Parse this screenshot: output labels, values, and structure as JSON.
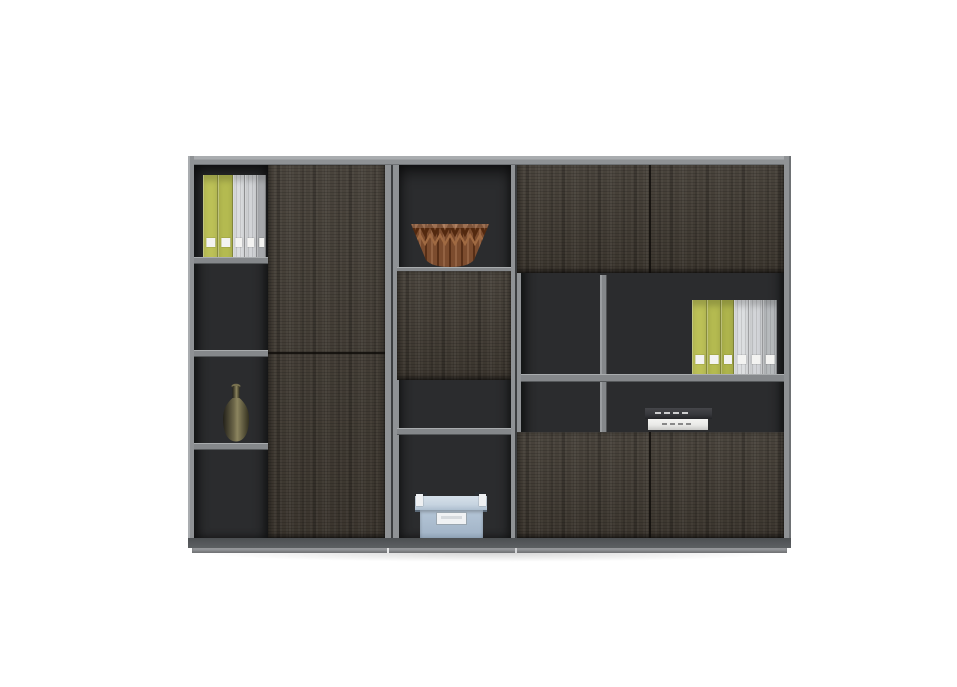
{
  "image": {
    "type": "product-photo",
    "subject": "dark wood modular office wall cabinet with open shelves, doors and decor objects",
    "background": "#ffffff"
  },
  "palette": {
    "background": "#ffffff",
    "frame": "#8f9295",
    "frame_light": "#a9acaf",
    "frame_dark": "#6e7174",
    "seam": "#3c3e40",
    "interior": "#2b2c2e",
    "interior_deep": "#1f2022",
    "wood": "#403a32",
    "wood_light": "#5a5248",
    "wood_dark": "#2a2620",
    "shelf": "#85888b",
    "rail": "#5d6063",
    "plinth_lip": "#96989b",
    "binder_label": "#f3f3f1",
    "book_dark": "#36373b",
    "book_white": "#e9e9e7",
    "box_blue": "#b5c6d7",
    "box_lid": "#c7d4e0",
    "box_label": "#f0f2f4"
  },
  "cabinet": {
    "label": "three-module wall cabinet",
    "modules": [
      {
        "id": "left",
        "features": [
          "open-shelf-column with four compartments",
          "tall two-panel wood door"
        ]
      },
      {
        "id": "middle",
        "features": [
          "open display compartment",
          "wood panel",
          "open shelf",
          "lower storage compartment"
        ]
      },
      {
        "id": "right",
        "features": [
          "two top doors",
          "open shelves with center divider",
          "two bottom doors"
        ]
      }
    ]
  },
  "objects": {
    "left_binders": {
      "label": "row of office binders on top-left shelf",
      "count": 5,
      "items": [
        {
          "name": "binder-green",
          "color": "#bcc157",
          "width": 15
        },
        {
          "name": "binder-green",
          "color": "#b4ba50",
          "width": 15
        },
        {
          "name": "binder-white",
          "color": "#dcdee0",
          "width": 12,
          "lined": true
        },
        {
          "name": "binder-white",
          "color": "#d3d5d8",
          "width": 12,
          "lined": true
        },
        {
          "name": "binder-gray",
          "color": "#aaadb0",
          "width": 9
        }
      ]
    },
    "right_binders": {
      "label": "row of office binders on right middle shelf",
      "count": 6,
      "items": [
        {
          "name": "binder-green",
          "color": "#bcc157",
          "width": 15
        },
        {
          "name": "binder-green",
          "color": "#b4ba50",
          "width": 14
        },
        {
          "name": "binder-green",
          "color": "#aeb44c",
          "width": 13
        },
        {
          "name": "binder-white",
          "color": "#dcdee0",
          "width": 15,
          "lined": true
        },
        {
          "name": "binder-white",
          "color": "#d3d5d8",
          "width": 14,
          "lined": true
        },
        {
          "name": "binder-gray",
          "color": "#b7babd",
          "width": 14,
          "lined": true
        }
      ]
    },
    "olive_vase": {
      "label": "dark olive bottle vase",
      "color": "#6d6749"
    },
    "copper_bowl": {
      "label": "faceted copper origami bowl",
      "color": "#8a5638"
    },
    "storage_box": {
      "label": "light blue storage box with label plate and metal clips",
      "color": "#b5c6d7"
    },
    "books": {
      "label": "two stacked books",
      "count": 2,
      "colors": [
        "#36373b",
        "#e9e9e7"
      ]
    }
  }
}
